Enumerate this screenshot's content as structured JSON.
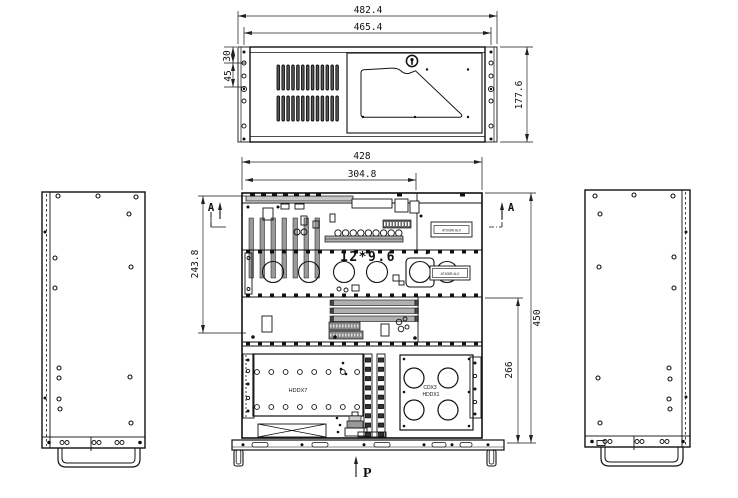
{
  "front_view": {
    "dim_overall_width": "482.4",
    "dim_inner_width": "465.4",
    "dim_height": "177.6",
    "dim_ear_top": "30",
    "dim_ear_mid": "45"
  },
  "plan_view": {
    "dim_overall_width": "428",
    "dim_slot_width": "304.8",
    "dim_left_depth": "243.8",
    "dim_overall_depth": "450",
    "dim_bay_depth": "266",
    "motherboard_size": "12*9.6",
    "section_marker": "A",
    "load_marker": "P",
    "label_hdd_cage": "HDDX7",
    "label_cd_bay": "CDX3",
    "label_hdd_bay": "HDDX1",
    "part_tag_rear": "ATX00R.ALX",
    "part_tag_fan": "ATX00R.ALX"
  }
}
